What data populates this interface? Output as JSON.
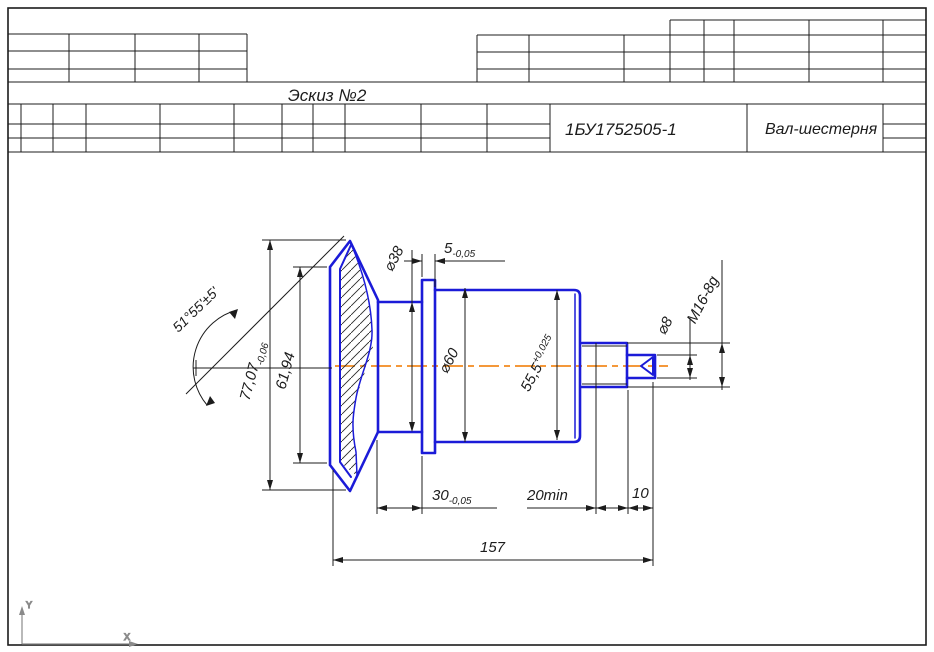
{
  "title_block": {
    "sketch_label": "Эскиз №2",
    "doc_number": "1БУ1752505-1",
    "part_name": "Вал-шестерня"
  },
  "dimensions": {
    "angle": "51°55'±5'",
    "d77": {
      "value": "77,07",
      "tol": "-0,06"
    },
    "d61": {
      "value": "61,94"
    },
    "dia38": {
      "value": "⌀38"
    },
    "d5": {
      "value": "5",
      "tol": "-0,05"
    },
    "dia60": {
      "value": "⌀60"
    },
    "d55": {
      "value": "55,5",
      "tol": "+0,025"
    },
    "dia8": {
      "value": "⌀8"
    },
    "thread": {
      "value": "M16-8g"
    },
    "d30": {
      "value": "30",
      "tol": "-0,05"
    },
    "d20": {
      "value": "20min"
    },
    "d10": {
      "value": "10"
    },
    "d157": {
      "value": "157"
    }
  },
  "ucs": {
    "x_label": "X",
    "y_label": "Y"
  },
  "colors": {
    "outline": "#1b1bd8",
    "centerline": "#f28a1e",
    "line": "#1c1c1c",
    "ucs": "#8a8a8a"
  }
}
